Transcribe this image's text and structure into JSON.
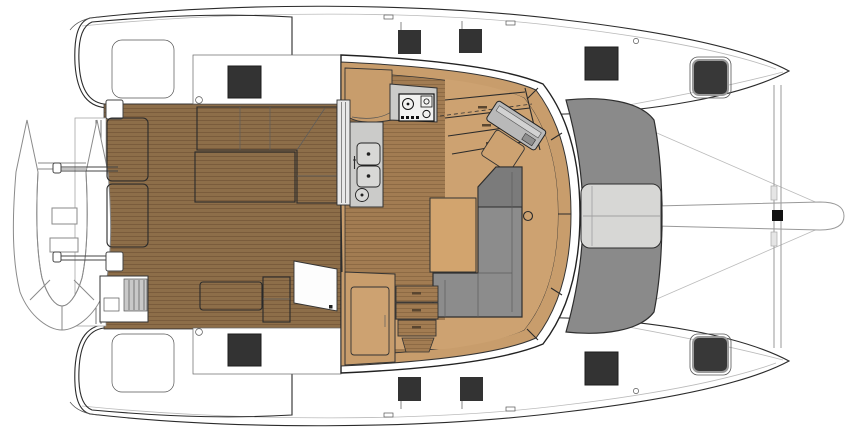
{
  "title": "Catamaran deck plan (top view)",
  "diagram": {
    "type": "boat-deck-plan",
    "vessel": "sailing catamaran",
    "orientation": "bow-right",
    "text_labels": [],
    "features": [
      "port-hull",
      "starboard-hull",
      "tender-on-davits",
      "transom-platform",
      "aft-bench-cushions",
      "cockpit-grill-module",
      "cockpit-l-sofa",
      "cockpit-table",
      "aft-cockpit-bench",
      "helm-seat-outline",
      "sliding-door",
      "galley-stove",
      "galley-double-sink",
      "stairs-to-port-hull",
      "stairs-to-starboard-hull",
      "nav-station",
      "salon-l-sofa",
      "salon-table",
      "salon-cabinet",
      "foredeck-sunpad",
      "forward-seat",
      "trampoline",
      "forward-crossbeam",
      "bowsprit",
      "deck-hatches"
    ],
    "counts": {
      "bow_hatches": 4,
      "side_deck_hatches": 4,
      "stern_deck_hatches": 2,
      "davits": 2,
      "sink_bowls": 2,
      "stove_burners": 2
    }
  },
  "colors": {
    "teak_deck": "#8D6E49",
    "teak_stripe": "#7A5C3C",
    "salon_floor": "#A27C52",
    "salon_floor_stripe": "#8D6A44",
    "interior_tan": "#CDA271",
    "wall_tan": "#C89D6C",
    "table_tan": "#D2A46E",
    "cushion_gray": "#8C8C8C",
    "cushion_gray_dark": "#7B7B7B",
    "sunpad_gray": "#8A8A8A",
    "seat_light": "#D7D7D5",
    "counter_gray": "#CBCBC9",
    "hatch_dark": "#333333",
    "outline": "#2B2B2B",
    "faint_line": "#BBBBBB"
  }
}
